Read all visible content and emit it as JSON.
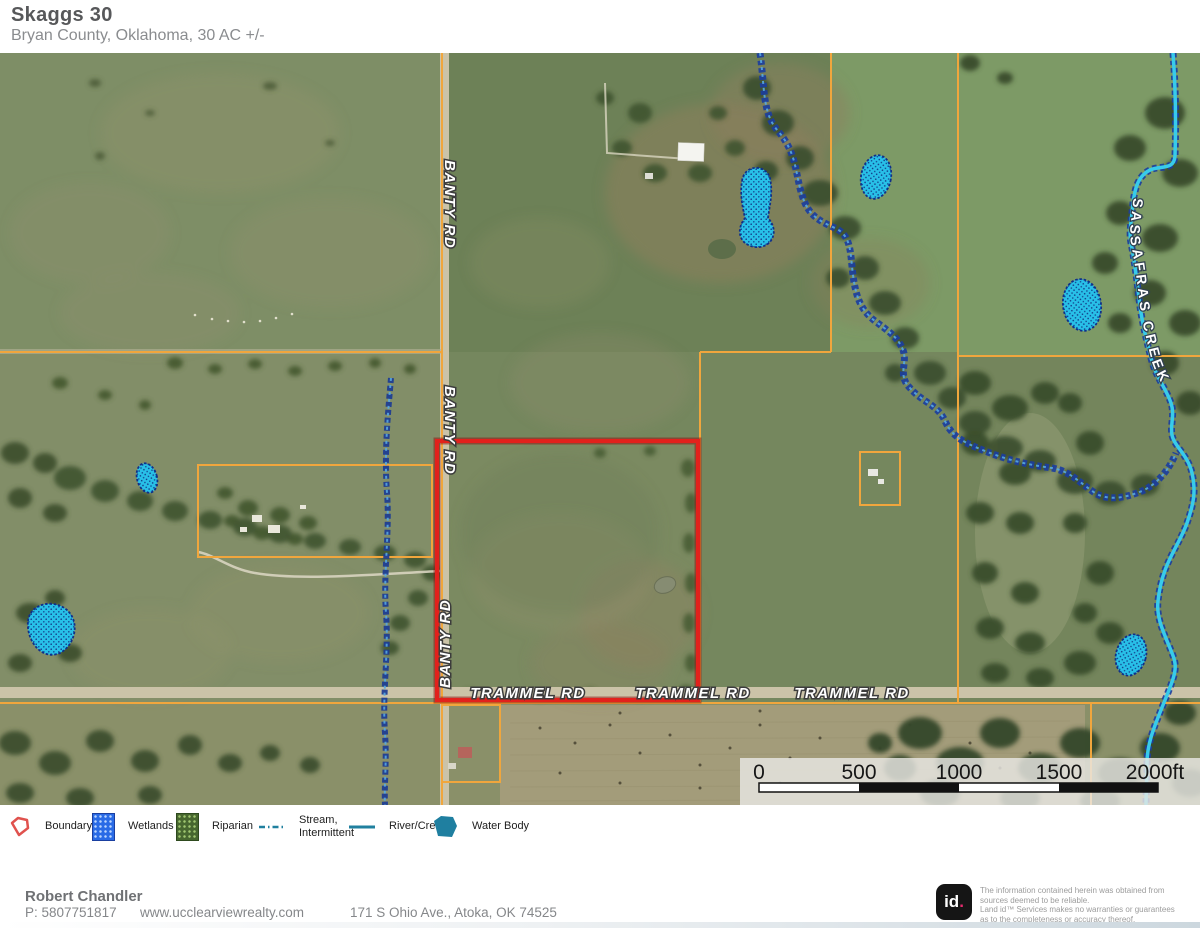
{
  "header": {
    "title": "Skaggs 30",
    "subtitle": "Bryan County, Oklahoma, 30 AC +/-"
  },
  "map": {
    "road_labels": {
      "banty_rd": "BANTY RD",
      "trammel_rd": "TRAMMEL RD",
      "sassafras_creek": "SASSAFRAS CREEK"
    },
    "scale_bar": {
      "ticks": [
        "0",
        "500",
        "1000",
        "1500"
      ],
      "end": "2000ft"
    }
  },
  "legend": {
    "items": [
      {
        "label": "Boundary"
      },
      {
        "label": "Wetlands"
      },
      {
        "label": "Riparian"
      },
      {
        "label": "Stream,",
        "label2": "Intermittent"
      },
      {
        "label": "River/Creek"
      },
      {
        "label": "Water Body"
      }
    ]
  },
  "footer": {
    "agent_name": "Robert Chandler",
    "phone": "P: 5807751817",
    "website": "www.ucclearviewrealty.com",
    "address": "171 S Ohio Ave., Atoka, OK 74525"
  },
  "branding": {
    "logo_main": "id",
    "logo_dot": ".",
    "disclaimer_lines": [
      "The information contained herein was obtained from",
      "sources deemed to be reliable.",
      "Land id™  Services makes no warranties or guarantees",
      "as to the completeness or accuracy thereof."
    ]
  },
  "colors": {
    "boundary_red": "#e2211c",
    "parcel_line_orange": "#f0a63d",
    "river_creek_cyan": "#38cbea",
    "wetland_fill": "#28c0e8",
    "stream_blue": "#1c3c94",
    "legend_teal": "#20809f",
    "logo_dot_pink": "#e72a6e"
  }
}
